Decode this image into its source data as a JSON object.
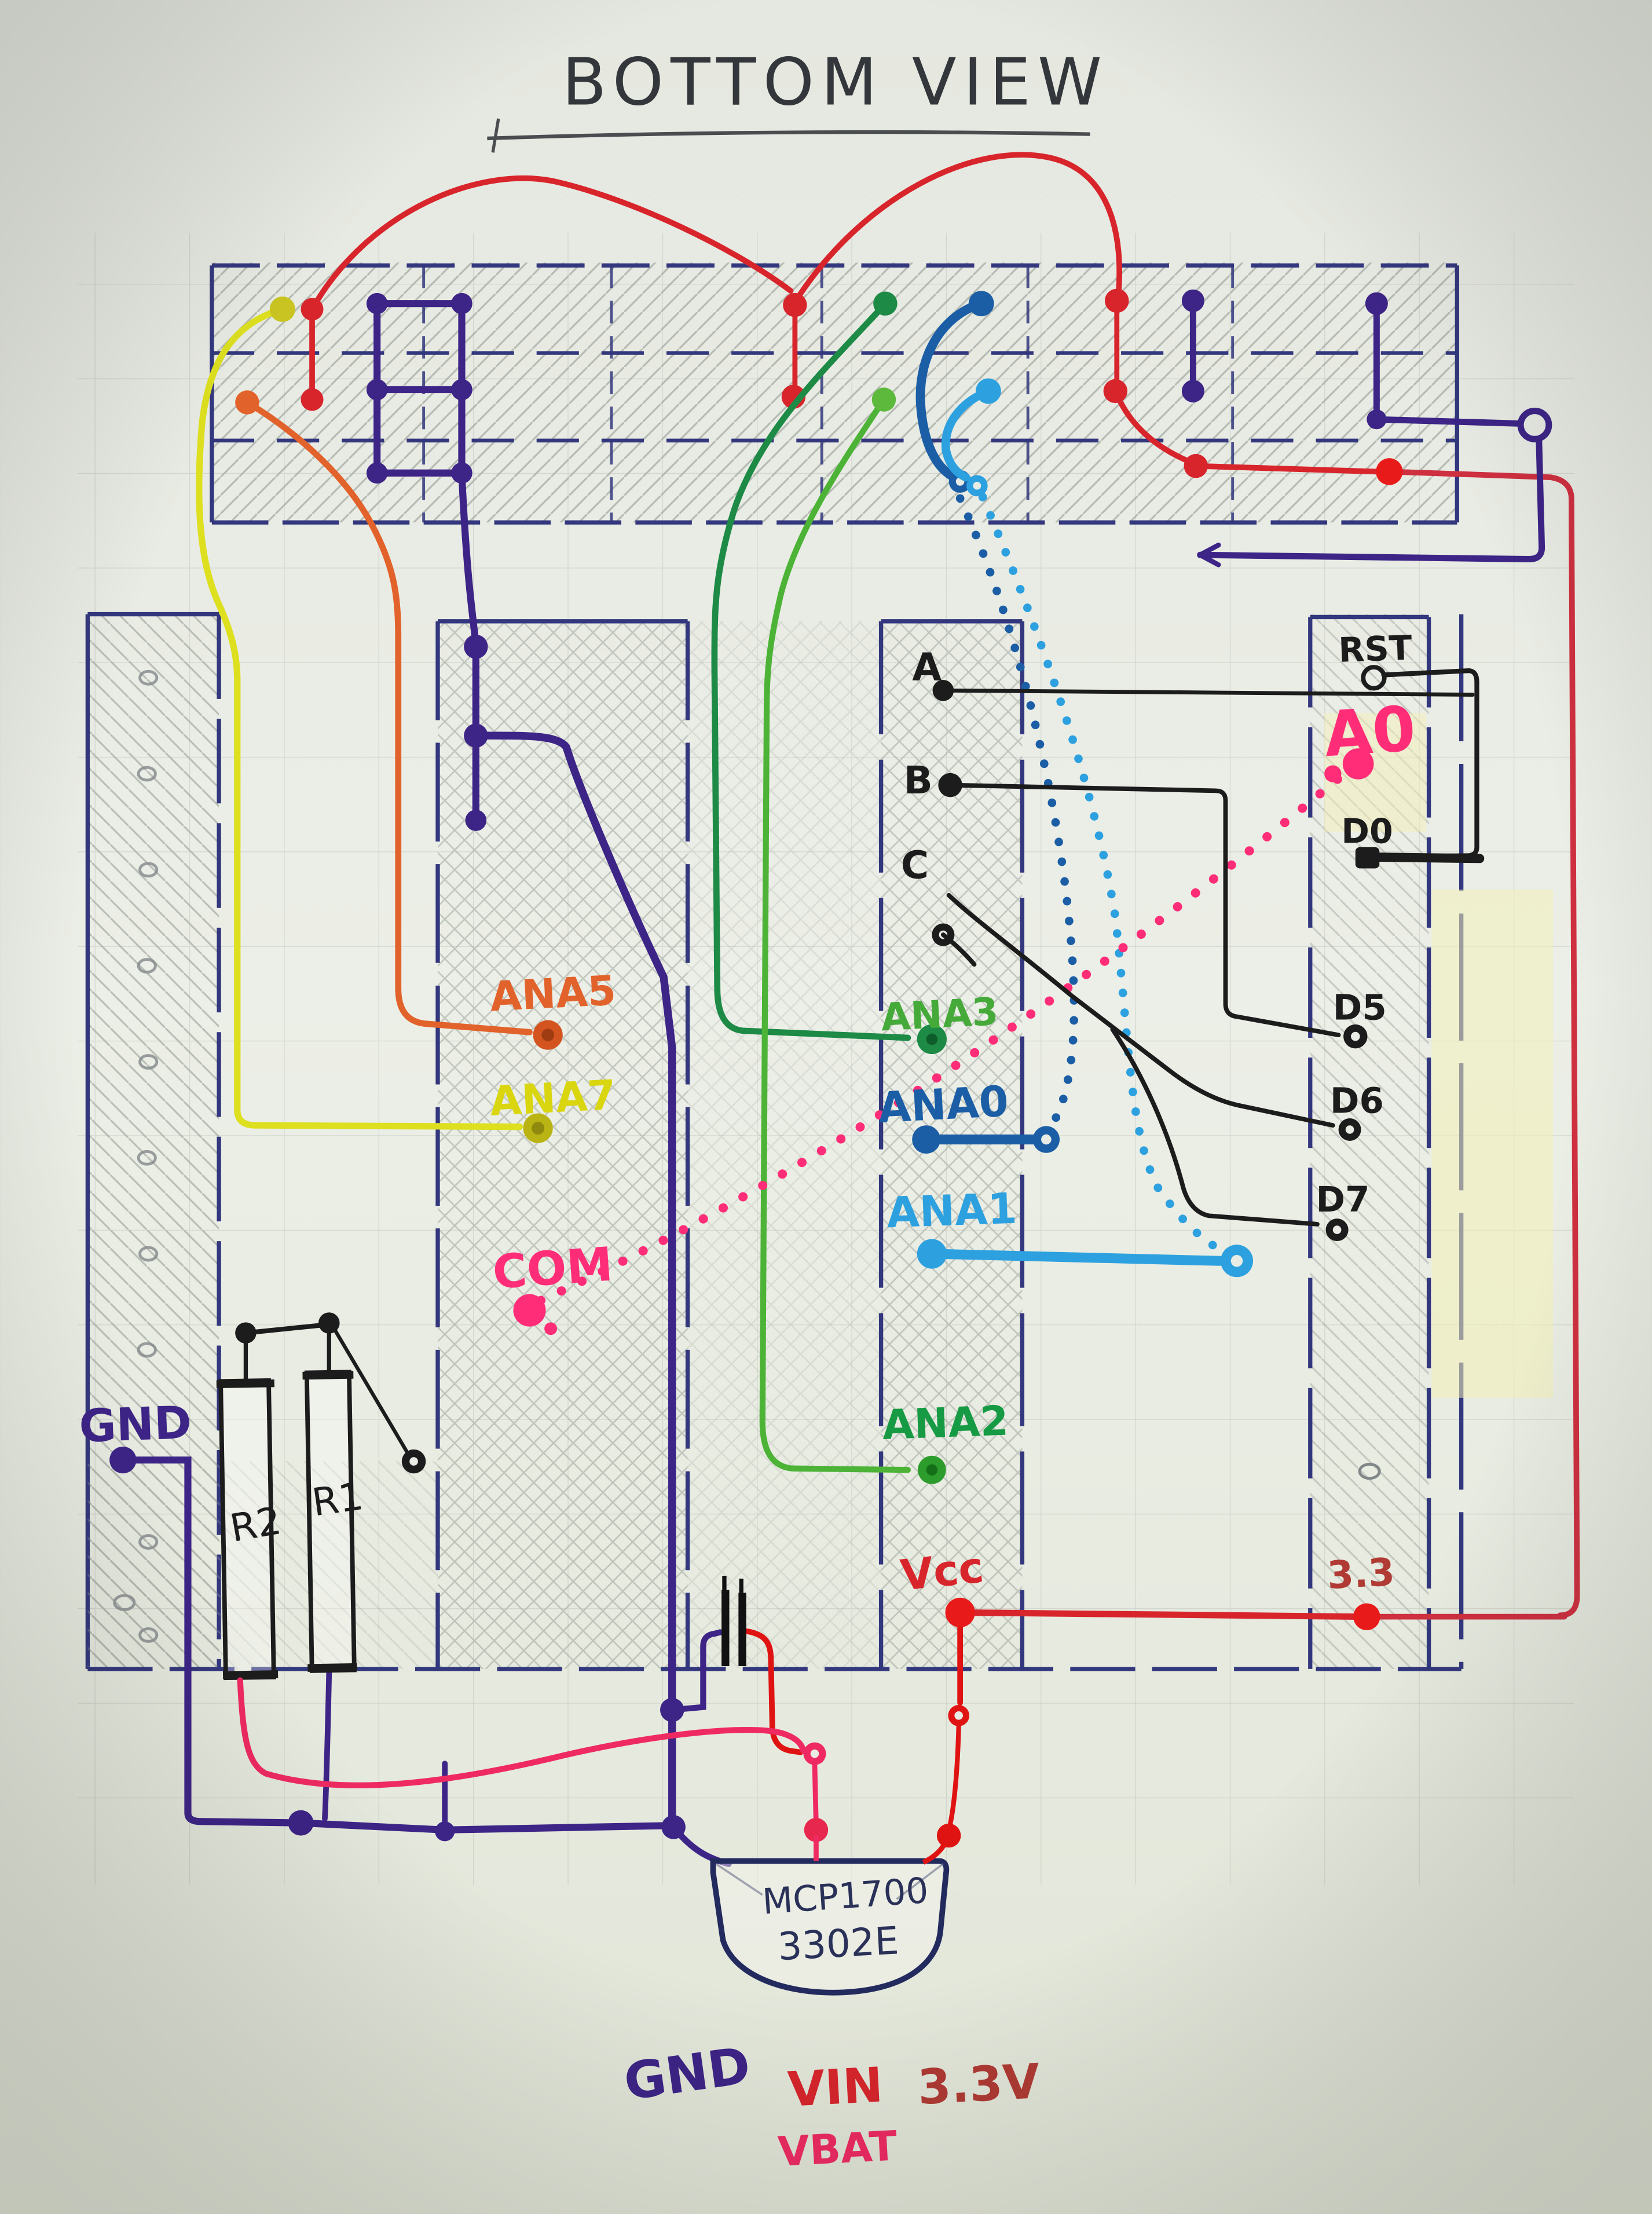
{
  "title": "BOTTOM VIEW",
  "connector_labels": {
    "a": "A",
    "b": "B",
    "c": "C",
    "rst": "RST",
    "a0": "A0",
    "d0": "D0",
    "d5": "D5",
    "d6": "D6",
    "d7": "D7"
  },
  "analog_labels": {
    "ana5": "ANA5",
    "ana7": "ANA7",
    "com": "COM",
    "ana3": "ANA3",
    "ana0": "ANA0",
    "ana1": "ANA1",
    "ana2": "ANA2"
  },
  "power_labels": {
    "gnd": "GND",
    "vcc": "Vcc",
    "v33": "3.3"
  },
  "components": {
    "r1": "R1",
    "r2": "R2",
    "regulator_line1": "MCP1700",
    "regulator_line2": "3302E"
  },
  "regulator_pins": {
    "gnd": "GND",
    "vin": "VIN",
    "vbat": "VBAT",
    "vout": "3.3V"
  },
  "colors": {
    "paper": "#e9ece4",
    "pencil": "#9aa09a",
    "navy": "#33377d",
    "purple": "#3d2487",
    "black": "#1c1c1c",
    "red": "#d8252c",
    "bright_red": "#e81a1a",
    "dark_red": "#b03a34",
    "pink": "#ff2d78",
    "rose": "#ef2a63",
    "orange": "#e2622b",
    "yellow": "#d9d610",
    "olive": "#b9b414",
    "dark_green": "#1d8a46",
    "light_green": "#45aa39",
    "green_text": "#169a43",
    "navy_blue": "#1b5ea6",
    "light_blue": "#2da1e0",
    "title_ink": "#33363a",
    "highlight": "#f3f0b8"
  }
}
